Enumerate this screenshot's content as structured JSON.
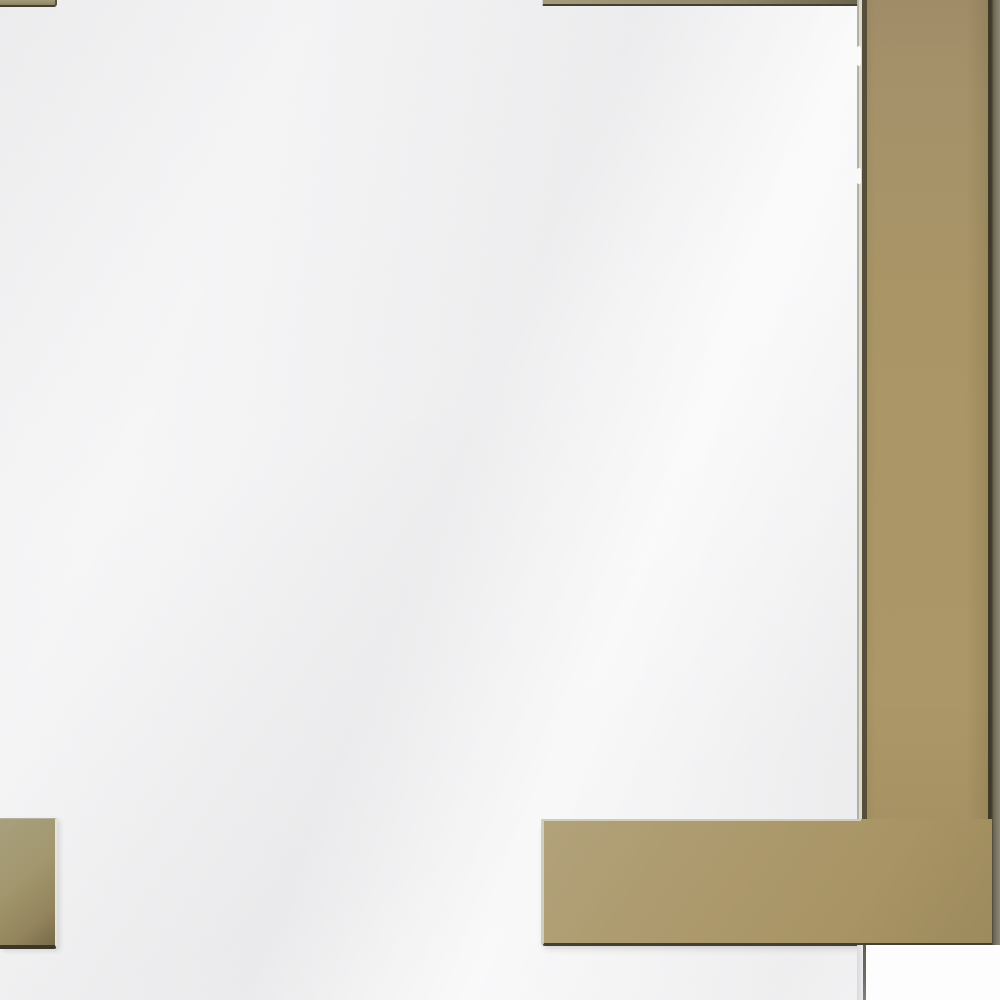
{
  "scene": {
    "type": "product-photo",
    "subject": "Close-up corner detail of a frameless square mirror with polished brass Greek-key corner accent bars on a white wall",
    "objects": [
      {
        "name": "mirror-glass",
        "description": "near-white mirror surface with faint diagonal reflections"
      },
      {
        "name": "right-accent-bar",
        "description": "vertical polished brass bar along the right edge, ends above the mirror bottom"
      },
      {
        "name": "bottom-right-accent-arm",
        "description": "horizontal brass arm forming an L with the vertical bar"
      },
      {
        "name": "bottom-left-accent-bar",
        "description": "horizontal brass bar entering from the left edge"
      },
      {
        "name": "accent-top-left-bar",
        "description": "thin brass sliver cropped at the top-left edge"
      },
      {
        "name": "accent-top-right-bar",
        "description": "thin brass sliver along the top edge meeting the vertical bar"
      },
      {
        "name": "mirror-side-edge",
        "description": "gray mirror edge line visible below the brass bar"
      }
    ],
    "colors": {
      "wall_white": "#fdfdfd",
      "mirror_white": "#f6f6f7",
      "brass_base": "#a99566",
      "brass_light": "#b2a277",
      "brass_dark": "#8f7e55",
      "brass_olive": "#8d8766",
      "edge_dark": "#45402c",
      "edge_highlight": "#dddad0",
      "edge_gray": "#b2b0a7",
      "side_shade": "#8f897a",
      "mirror_edge_line": "#6f6d66",
      "mirror_edge_strip": "#d9d9db"
    }
  }
}
